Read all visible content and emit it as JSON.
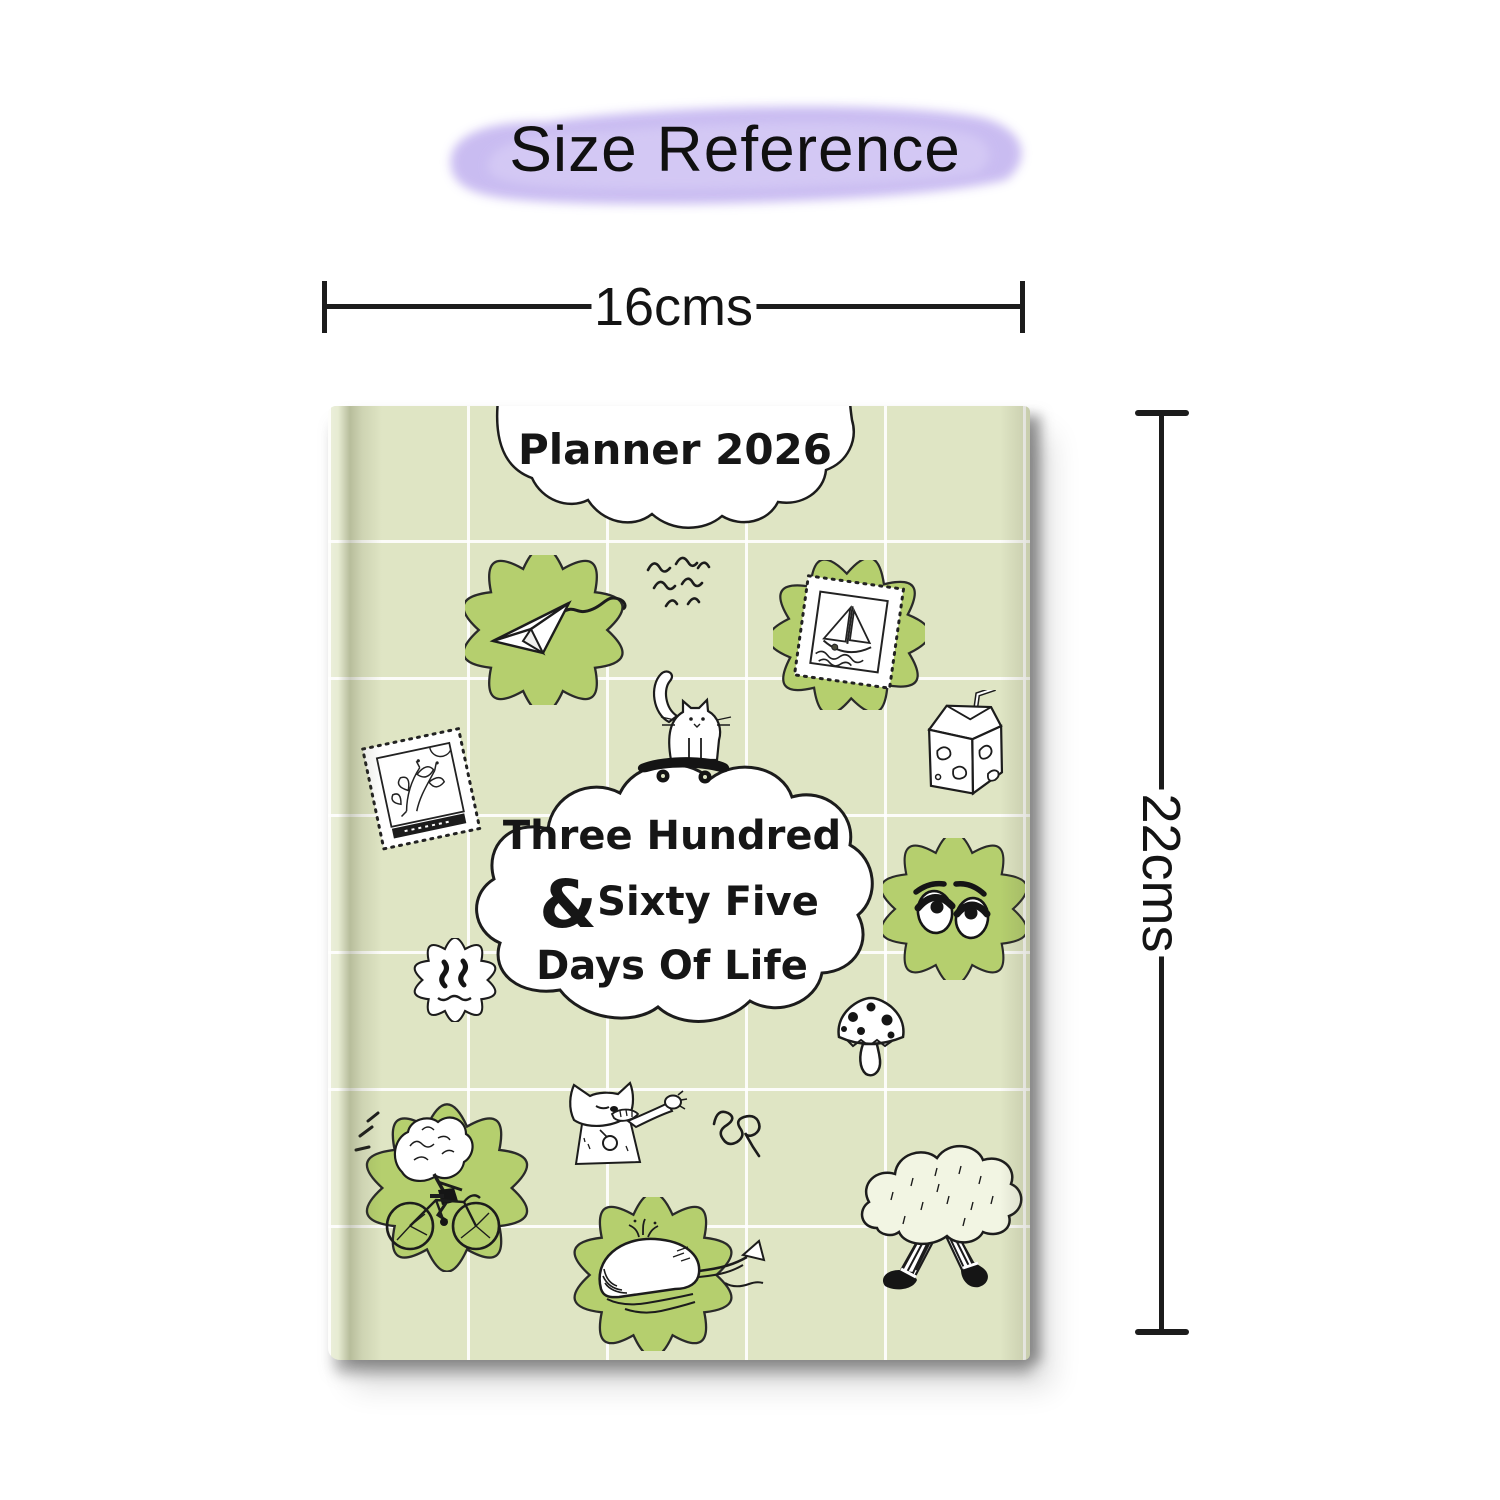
{
  "page": {
    "title": "Size Reference"
  },
  "dimensions": {
    "width_label": "16cms",
    "height_label": "22cms"
  },
  "book": {
    "header": "Planner 2026",
    "cover_line1": "Three Hundred",
    "cover_amp": "&",
    "cover_line2": "Sixty Five",
    "cover_line3": "Days Of Life"
  },
  "colors": {
    "ink": "#1c1c1c",
    "cover": "#dfe5c4",
    "badge": "#b5cf6e",
    "swash": "#c7b9f1",
    "swash_light": "#d9cff6"
  },
  "doodles": [
    {
      "name": "paper-plane-doodle"
    },
    {
      "name": "flying-birds-doodle"
    },
    {
      "name": "sailboat-stamp-doodle"
    },
    {
      "name": "milk-carton-doodle"
    },
    {
      "name": "flower-stamp-doodle"
    },
    {
      "name": "cat-on-skateboard-doodle"
    },
    {
      "name": "sleepy-face-doodle"
    },
    {
      "name": "melting-smiley-doodle"
    },
    {
      "name": "mushroom-doodle"
    },
    {
      "name": "dabbing-cat-doodle"
    },
    {
      "name": "spiral-squiggle-doodle"
    },
    {
      "name": "brain-cyclist-doodle"
    },
    {
      "name": "whale-doodle"
    },
    {
      "name": "walking-bush-doodle"
    }
  ]
}
